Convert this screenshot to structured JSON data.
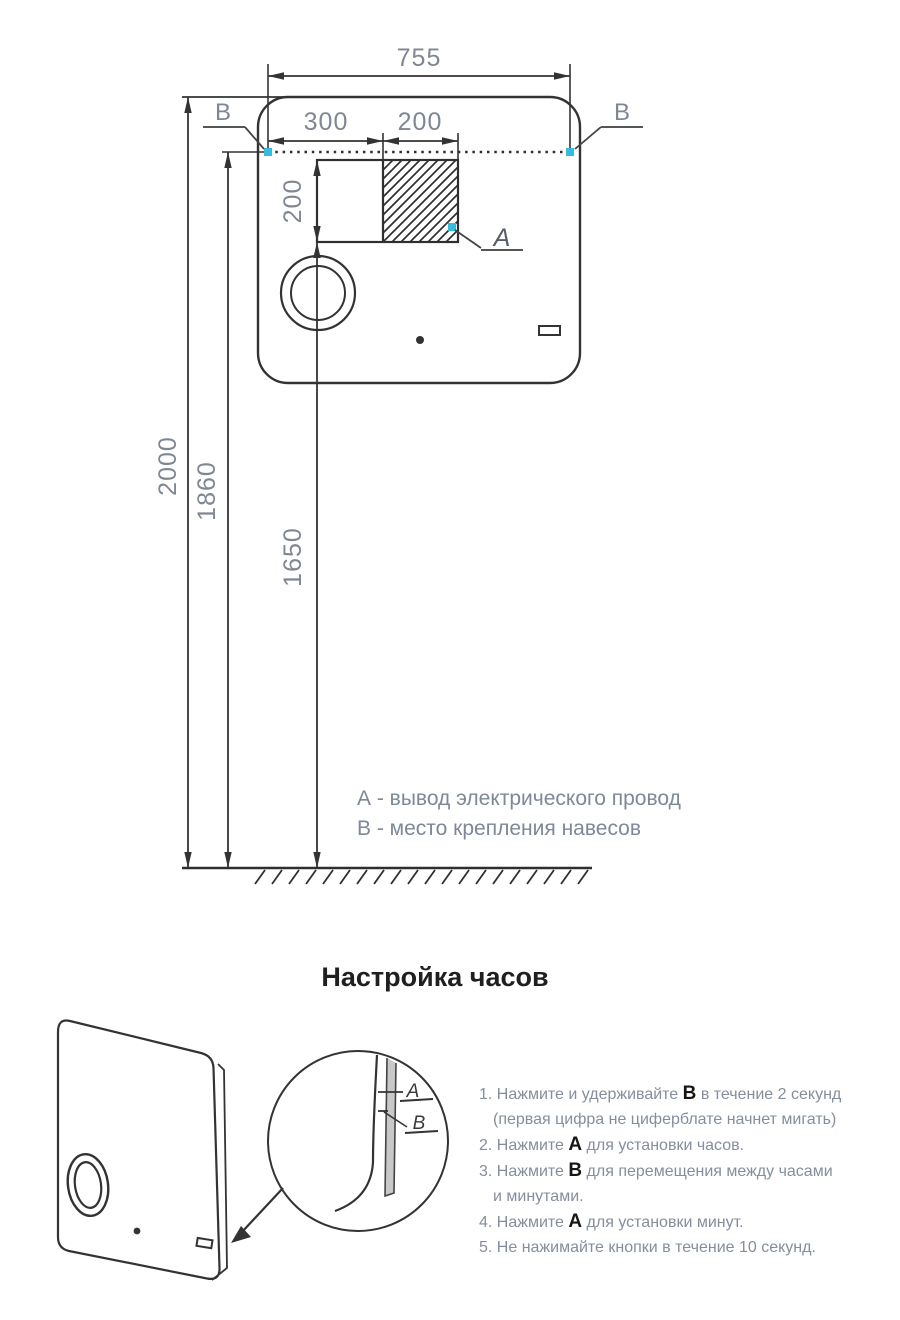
{
  "installation": {
    "dims": {
      "width": "755",
      "offset_left": "300",
      "outlet_width": "200",
      "outlet_height": "200",
      "height_total": "2000",
      "height_mount": "1860",
      "height_outlet": "1650"
    },
    "labels": {
      "a": "A",
      "b_left": "B",
      "b_right": "B"
    },
    "legend": {
      "line_a": "А - вывод электрического провод",
      "line_b": "В - место крепления навесов"
    }
  },
  "clock": {
    "title": "Настройка часов",
    "detail": {
      "a": "A",
      "b": "B"
    },
    "steps": {
      "s1a": "1. Нажмите и удерживайте ",
      "s1b": "B",
      "s1c": " в течение 2 секунд",
      "s1d": "(первая цифра не циферблате начнет мигать)",
      "s2a": "2. Нажмите ",
      "s2b": "A",
      "s2c": " для установки часов.",
      "s3a": "3. Нажмите ",
      "s3b": "B",
      "s3c": " для перемещения между часами",
      "s3d": "и минутами.",
      "s4a": "4. Нажмите ",
      "s4b": "A",
      "s4c": " для установки минут.",
      "s5a": "5. Не нажимайте кнопки в течение 10 секунд."
    }
  },
  "colors": {
    "marker": "#35bbdc",
    "line": "#333333"
  }
}
